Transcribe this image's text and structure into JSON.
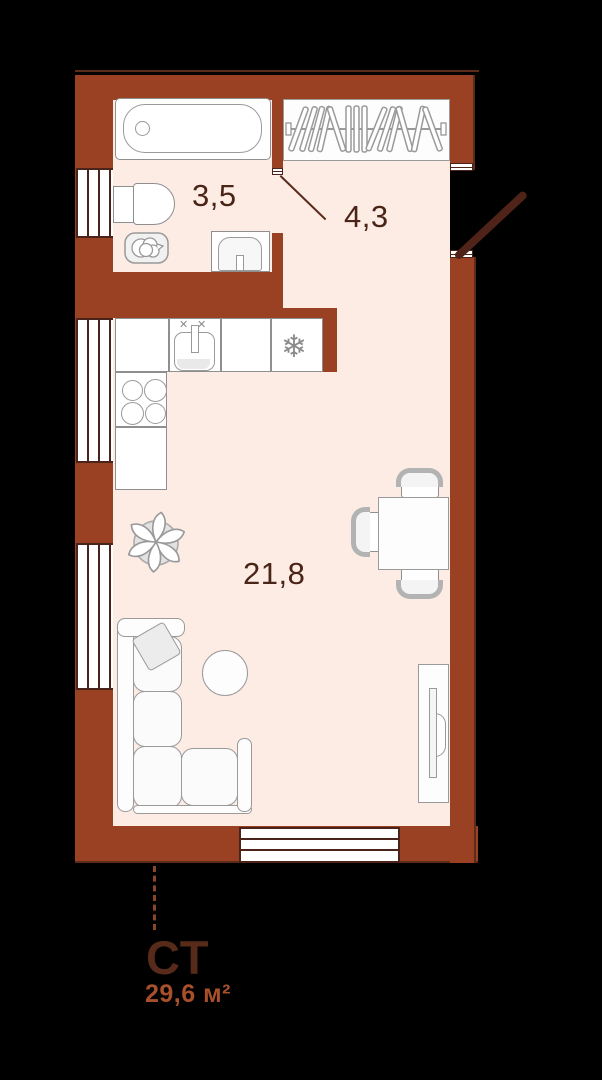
{
  "plan_title": "studio-floor-plan",
  "rooms": {
    "bathroom": {
      "label": "3,5"
    },
    "hallway": {
      "label": "4,3"
    },
    "living": {
      "label": "21,8"
    }
  },
  "footer": {
    "unit_type": "СТ",
    "total_area": "29,6 м²"
  },
  "icons": {
    "snowflake": "❄",
    "faucet_cross": "✕"
  },
  "colors": {
    "wall": "#9a4123",
    "wall_trim": "#5c2b1a",
    "floor": "#fcece4",
    "door_leaf": "#4f2317",
    "label_text": "#4a2417",
    "footer_type_text": "#572a19",
    "footer_area_text": "#a84f2b",
    "furniture_border": "#8f8f8f"
  }
}
